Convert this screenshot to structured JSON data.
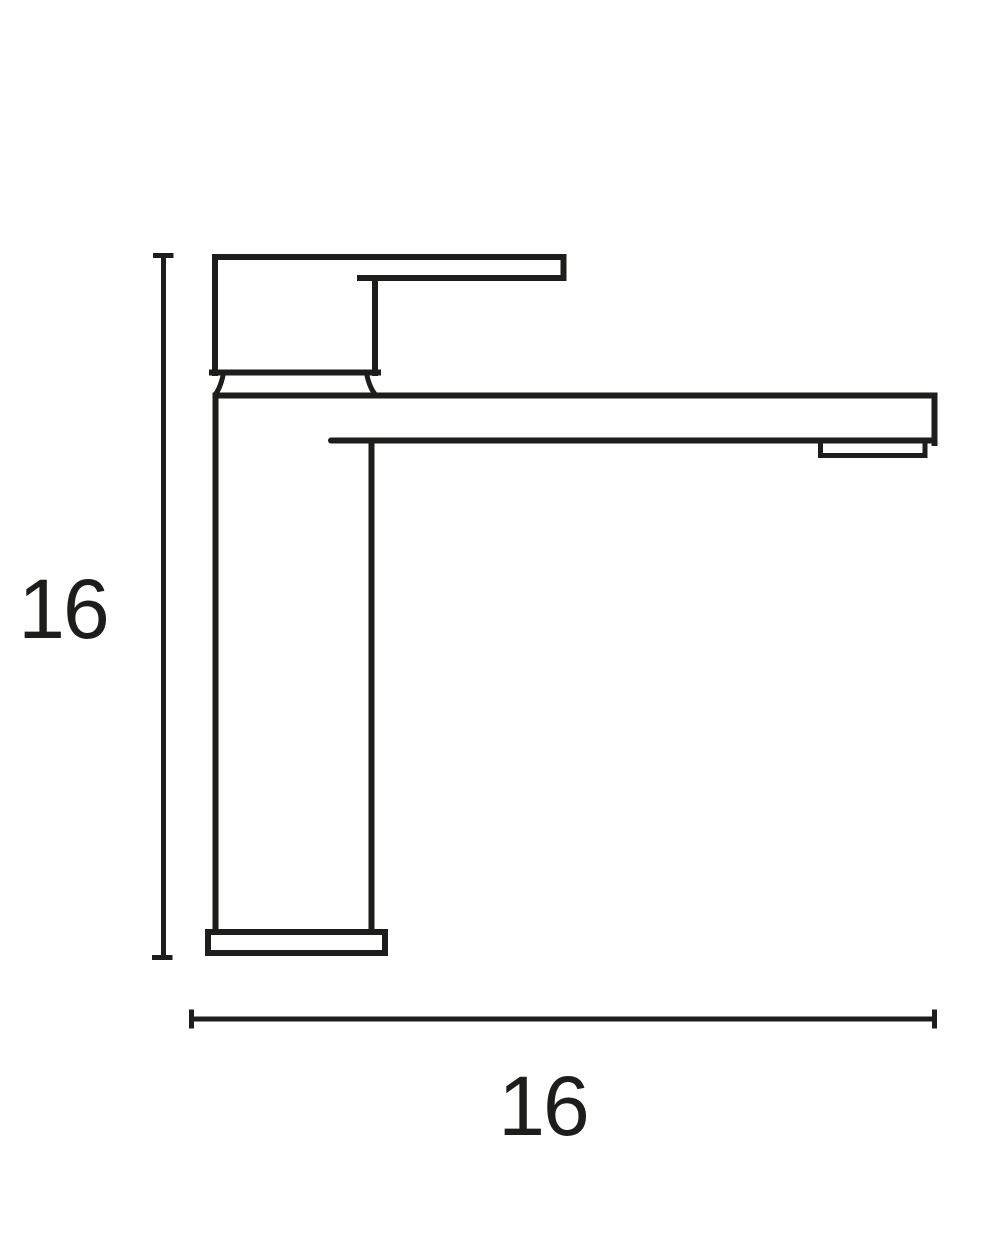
{
  "diagram": {
    "type": "technical-drawing",
    "subject": "single-lever basin mixer tap, side elevation",
    "height_dimension": {
      "value": "16"
    },
    "width_dimension": {
      "value": "16"
    }
  },
  "colors": {
    "ink": "#1d1d1b",
    "background": "#ffffff"
  }
}
